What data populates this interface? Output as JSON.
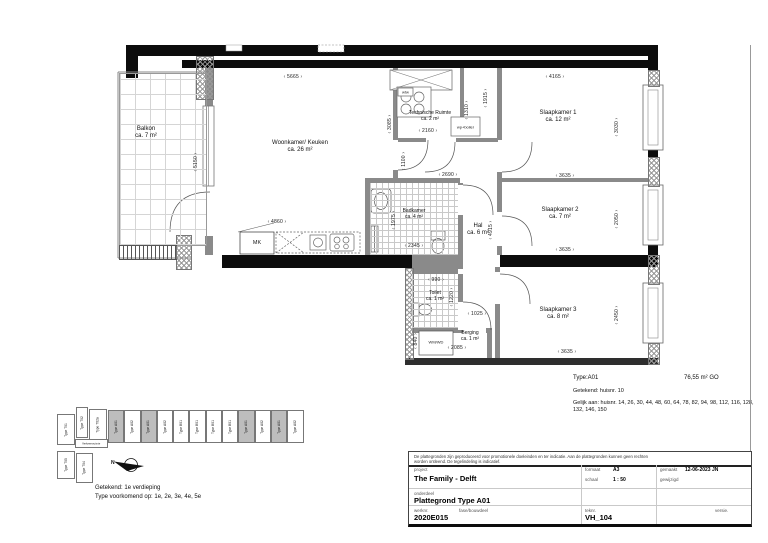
{
  "plan": {
    "rooms": {
      "balkon": {
        "name": "Balkon",
        "area": "ca. 7 m²"
      },
      "woonkamer": {
        "name": "Woonkamer/ Keuken",
        "area": "ca. 26 m²"
      },
      "technische": {
        "name": "Technische Ruimte",
        "area": "ca. 2 m²"
      },
      "slaapkamer1": {
        "name": "Slaapkamer 1",
        "area": "ca. 12 m²"
      },
      "slaapkamer2": {
        "name": "Slaapkamer 2",
        "area": "ca. 7 m²"
      },
      "slaapkamer3": {
        "name": "Slaapkamer 3",
        "area": "ca. 8 m²"
      },
      "badkamer": {
        "name": "Badkamer",
        "area": "ca. 4 m²"
      },
      "hal": {
        "name": "Hal",
        "area": "ca. 6 m²"
      },
      "toilet": {
        "name": "Toilet",
        "area": "ca. 1 m²"
      },
      "berging": {
        "name": "Berging",
        "area": "ca. 1 m²"
      }
    },
    "dims": {
      "d5665": "5665",
      "d4165": "4165",
      "d5150": "5150",
      "d3085": "3085",
      "d1915": "1915",
      "d1310": "1310",
      "d2160": "2160",
      "d1100": "1100",
      "d2690": "2690",
      "d4860": "4860",
      "d1975": "1975",
      "d2345": "2345",
      "d3030": "3030",
      "d3635_sl1": "3635",
      "d2050": "2050",
      "d3635_sl2": "3635",
      "d4915": "4915",
      "d990": "990",
      "d1220": "1220",
      "d1025": "1025",
      "d2085": "2085",
      "d840": "840",
      "d2450": "2450",
      "d3635_sl3": "3635"
    },
    "fixtures": {
      "mk": "MK",
      "wtw": "wtw",
      "wp_boiler": "wp+boiler",
      "wm_wd": "WM/WD"
    }
  },
  "info": {
    "type_label": "Type:A01",
    "area_go": "76,55 m² GO",
    "getekend": "Getekend: huisnr. 10",
    "gelijk_aan": "Gelijk aan: huisnr. 14, 26, 30, 44, 48, 60, 64, 78, 82, 94, 98, 112, 116, 128, 132, 146, 150"
  },
  "overview": {
    "left_units": [
      {
        "label": "Type T01"
      },
      {
        "label": "Type T02"
      },
      {
        "label": "Type T02a"
      },
      {
        "label": "Type T05"
      },
      {
        "label": "Type T04"
      }
    ],
    "corridor_label": "Verkeersruimte",
    "strip": [
      {
        "label": "Type A01",
        "highlight": true
      },
      {
        "label": "Type A02",
        "highlight": false
      },
      {
        "label": "Type A01",
        "highlight": true
      },
      {
        "label": "Type A02",
        "highlight": false
      },
      {
        "label": "Type B01",
        "highlight": false
      },
      {
        "label": "Type B01",
        "highlight": false
      },
      {
        "label": "Type B01",
        "highlight": false
      },
      {
        "label": "Type B01",
        "highlight": false
      },
      {
        "label": "Type A01",
        "highlight": true
      },
      {
        "label": "Type A02",
        "highlight": false
      },
      {
        "label": "Type A01",
        "highlight": true
      },
      {
        "label": "Type A02",
        "highlight": false
      }
    ],
    "north_label": "N",
    "caption1": "Getekend: 1e verdieping",
    "caption2": "Type voorkomend op: 1e, 2e, 3e, 4e, 5e"
  },
  "titleblock": {
    "disclaimer": "De plattegronden zijn geproduceerd voor promotionele doeleinden en ter indicatie. Aan de plattegronden kunnen geen rechten worden ontleend. De tegelindeling is indicatief.",
    "labels": {
      "project": "project",
      "onderdeel": "onderdeel",
      "werknr": "werknr.",
      "fase": "fase/bouwdeel",
      "formaat": "formaat",
      "schaal": "schaal",
      "teknr": "teknr.",
      "gemaakt": "gemaakt",
      "gewijzigd": "gewijzigd",
      "versie": "versie."
    },
    "values": {
      "project": "The Family - Delft",
      "onderdeel": "Plattegrond Type A01",
      "werknr": "2020E015",
      "formaat": "A3",
      "schaal": "1 : 50",
      "teknr": "VH_104",
      "gemaakt": "12-06-2023 JN"
    }
  }
}
